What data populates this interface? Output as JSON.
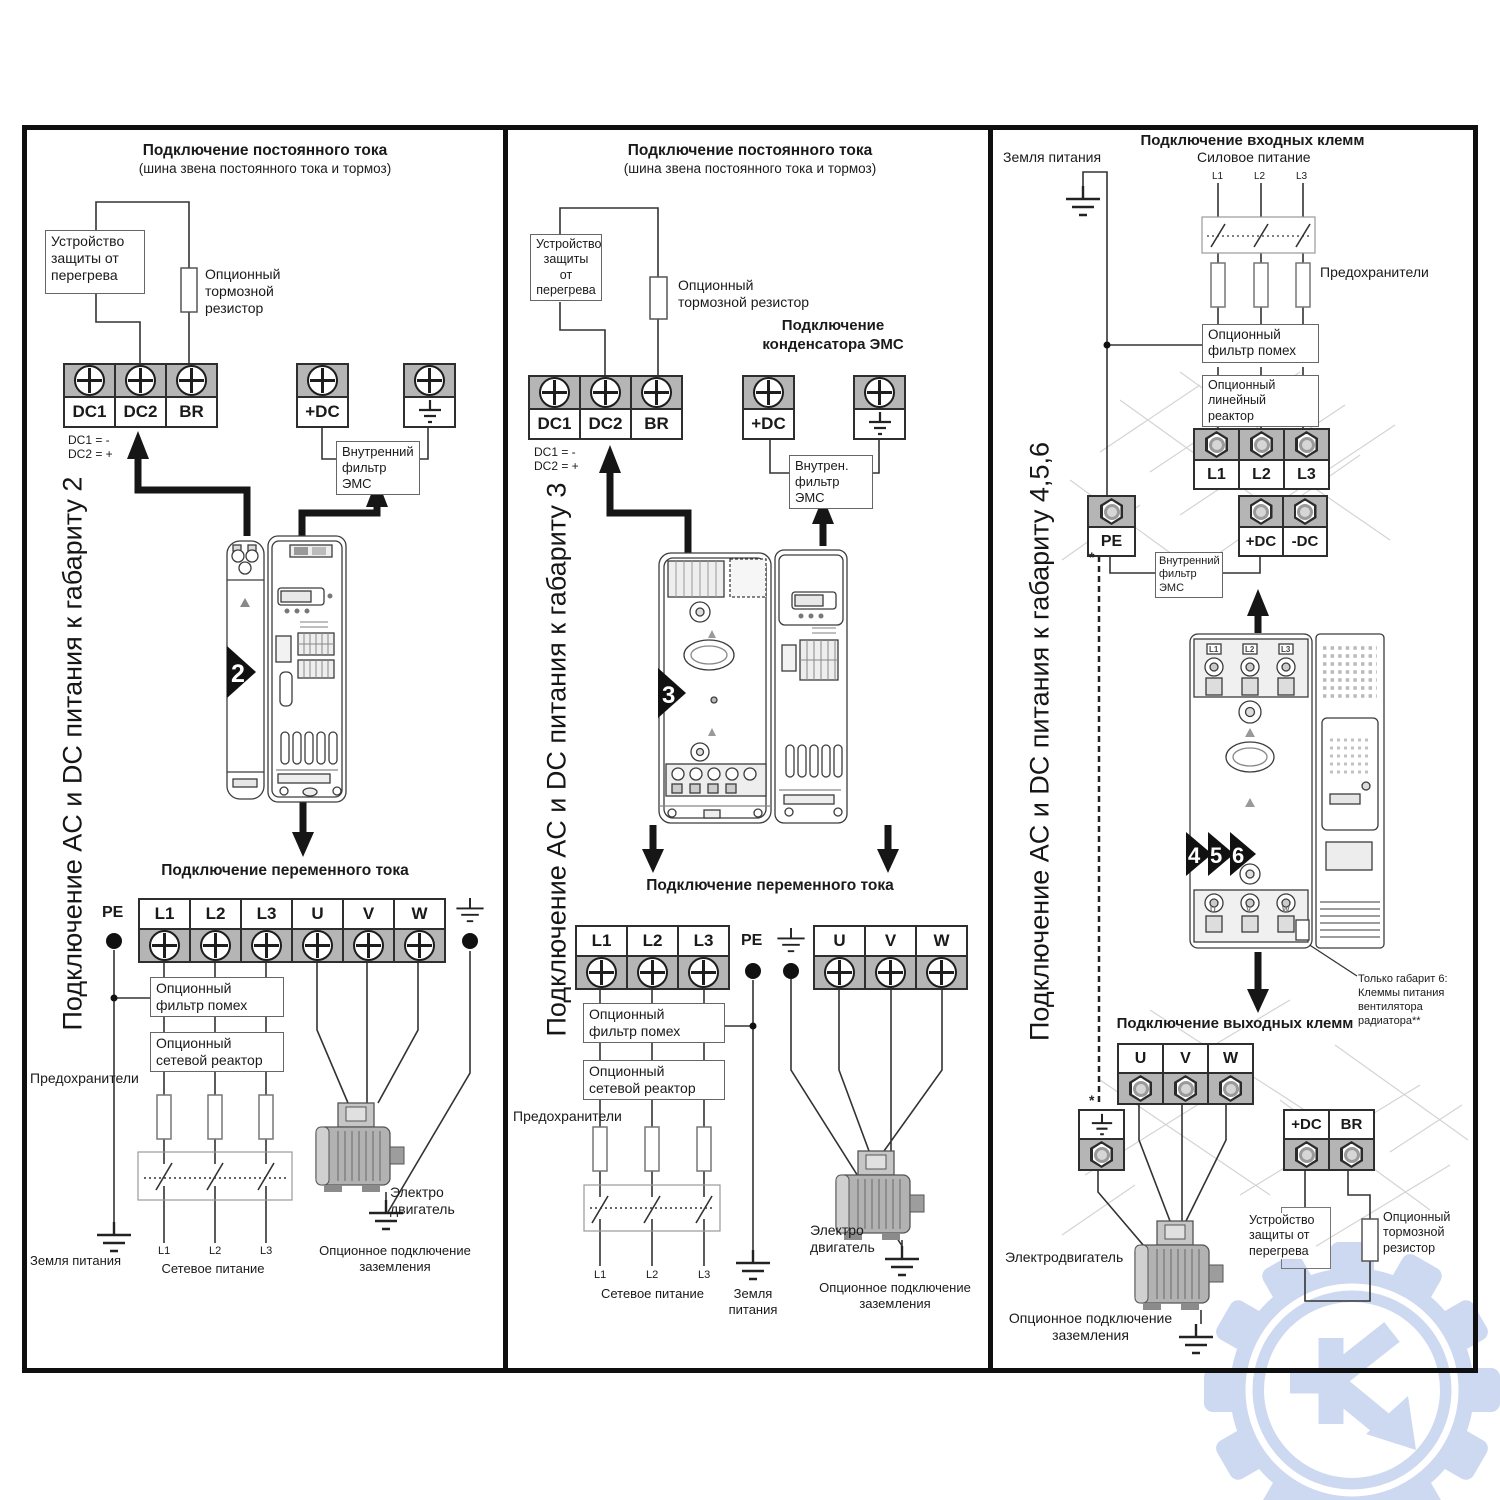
{
  "colors": {
    "terminal_gray": "#b5b5b5",
    "watermark_blue": "#ccd9f1",
    "line_dark": "#111111"
  },
  "p1": {
    "vertical": "Подключение AC и DC питания к габариту 2",
    "dc_title": "Подключение постоянного тока",
    "dc_subtitle": "(шина звена постоянного тока и тормоз)",
    "overheat": "Устройство\nзащиты от\nперегрева",
    "brake_res": "Опционный\nтормозной\nрезистор",
    "dc_terms": [
      "DC1",
      "DC2",
      "BR"
    ],
    "plus_dc": "+DC",
    "dc1_note": "DC1 = -",
    "dc2_note": "DC2 = +",
    "emc": "Внутренний\nфильтр ЭМС",
    "badge": "2",
    "ac_title": "Подключение переменного тока",
    "pe": "PE",
    "ac_terms": [
      "L1",
      "L2",
      "L3",
      "U",
      "V",
      "W"
    ],
    "noise": "Опционный\nфильтр помех",
    "reactor": "Опционный\nсетевой реактор",
    "fuses": "Предохранители",
    "phases": [
      "L1",
      "L2",
      "L3"
    ],
    "mains": "Сетевое питание",
    "ground": "Земля питания",
    "motor": "Электро\nдвигатель",
    "optg": "Опционное подключение\nзаземления"
  },
  "p2": {
    "vertical": "Подключение AC и DC питания к габариту 3",
    "dc_title": "Подключение постоянного тока",
    "dc_subtitle": "(шина звена постоянного тока и тормоз)",
    "overheat": "Устройство\nзащиты\nот\nперегрева",
    "brake_res": "Опционный\nтормозной резистор",
    "emc_cap": "Подключение\nконденсатора ЭМС",
    "dc_terms": [
      "DC1",
      "DC2",
      "BR"
    ],
    "plus_dc": "+DC",
    "dc1_note": "DC1 = -",
    "dc2_note": "DC2 = +",
    "emc": "Внутрен.\nфильтр ЭМС",
    "badge": "3",
    "ac_title": "Подключение переменного тока",
    "pe": "PE",
    "ac_terms": [
      "L1",
      "L2",
      "L3"
    ],
    "out_terms": [
      "U",
      "V",
      "W"
    ],
    "noise": "Опционный\nфильтр помех",
    "reactor": "Опционный\nсетевой реактор",
    "fuses": "Предохранители",
    "phases": [
      "L1",
      "L2",
      "L3"
    ],
    "mains": "Сетевое питание",
    "ground": "Земля\nпитания",
    "motor": "Электро\nдвигатель",
    "optg": "Опционное подключение\nзаземления"
  },
  "p3": {
    "vertical": "Подключение AC и DC питания к габариту 4,5,6",
    "input_title": "Подключение входных клемм",
    "ground": "Земля питания",
    "power": "Силовое питание",
    "phases": [
      "L1",
      "L2",
      "L3"
    ],
    "fuses": "Предохранители",
    "noise": "Опционный\nфильтр помех",
    "reactor": "Опционный\nлинейный реактор",
    "in_terms": [
      "L1",
      "L2",
      "L3"
    ],
    "pe": "PE",
    "dc_terms": [
      "+DC",
      "-DC"
    ],
    "emc": "Внутренний\nфильтр ЭМС",
    "badges": [
      "4",
      "5",
      "6"
    ],
    "fan_note": "Только габарит 6:\nКлеммы питания\nвентилятора\nрадиатора**",
    "output_title": "Подключение выходных клемм",
    "out_terms": [
      "U",
      "V",
      "W"
    ],
    "brake_terms": [
      "+DC",
      "BR"
    ],
    "motor": "Электродвигатель",
    "overheat": "Устройство\nзащиты от\nперегрева",
    "brake_res": "Опционный\nтормозной\nрезистор",
    "optg": "Опционное  подключение\nзаземления",
    "star": "*"
  }
}
